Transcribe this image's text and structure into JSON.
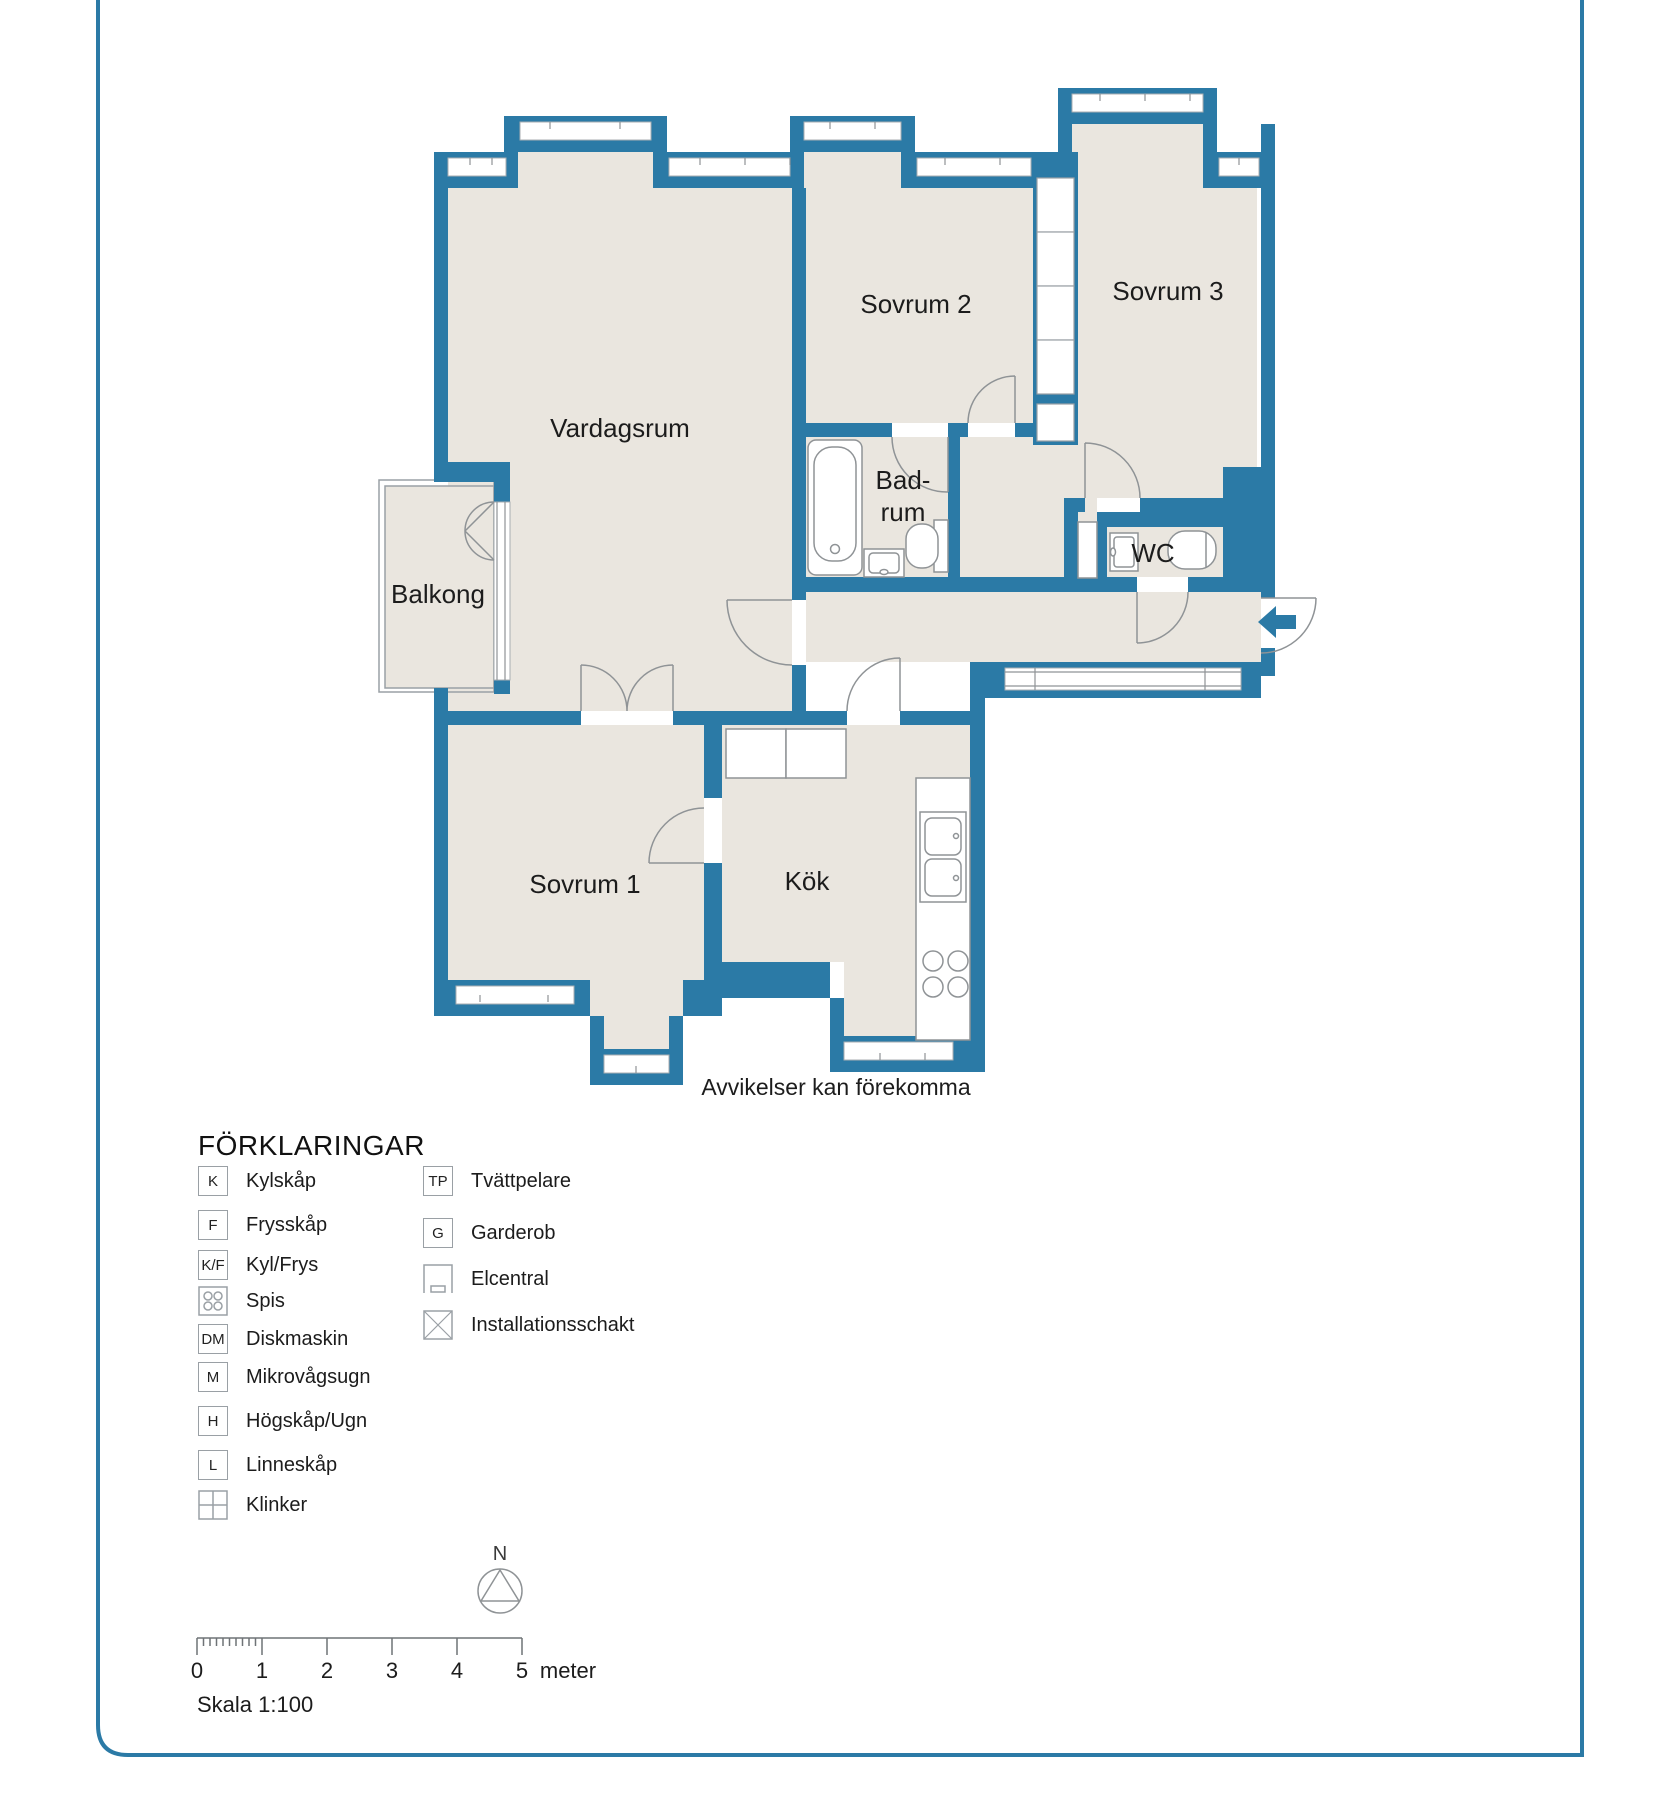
{
  "page": {
    "frame_color": "#2B7AA6",
    "background": "#ffffff"
  },
  "plan": {
    "wall_color": "#2B7AA6",
    "floor_color": "#EAE6DF",
    "fixture_line_color": "#8f9396",
    "rooms": [
      {
        "id": "vardagsrum",
        "label": "Vardagsrum"
      },
      {
        "id": "sovrum2",
        "label": "Sovrum 2"
      },
      {
        "id": "sovrum3",
        "label": "Sovrum 3"
      },
      {
        "id": "badrum-line1",
        "label": "Bad-"
      },
      {
        "id": "badrum-line2",
        "label": "rum"
      },
      {
        "id": "wc",
        "label": "WC"
      },
      {
        "id": "balkong",
        "label": "Balkong"
      },
      {
        "id": "sovrum1",
        "label": "Sovrum 1"
      },
      {
        "id": "kok",
        "label": "Kök"
      }
    ],
    "disclaimer": "Avvikelser kan förekomma"
  },
  "legend": {
    "title": "FÖRKLARINGAR",
    "left": [
      {
        "symbol": "K",
        "label": "Kylskåp"
      },
      {
        "symbol": "F",
        "label": "Frysskåp"
      },
      {
        "symbol": "K/F",
        "label": "Kyl/Frys"
      },
      {
        "symbol": null,
        "icon": "stove-icon",
        "label": "Spis"
      },
      {
        "symbol": "DM",
        "label": "Diskmaskin"
      },
      {
        "symbol": "M",
        "label": "Mikrovågsugn"
      },
      {
        "symbol": "H",
        "label": "Högskåp/Ugn"
      },
      {
        "symbol": "L",
        "label": "Linneskåp"
      },
      {
        "symbol": null,
        "icon": "tiles-icon",
        "label": "Klinker"
      }
    ],
    "right": [
      {
        "symbol": "TP",
        "label": "Tvättpelare"
      },
      {
        "symbol": "G",
        "label": "Garderob"
      },
      {
        "symbol": null,
        "icon": "elcentral-icon",
        "label": "Elcentral"
      },
      {
        "symbol": null,
        "icon": "shaft-icon",
        "label": "Installationsschakt"
      }
    ]
  },
  "compass": {
    "label": "N"
  },
  "scale_bar": {
    "ticks": [
      "0",
      "1",
      "2",
      "3",
      "4",
      "5"
    ],
    "unit": "meter",
    "caption": "Skala 1:100"
  }
}
